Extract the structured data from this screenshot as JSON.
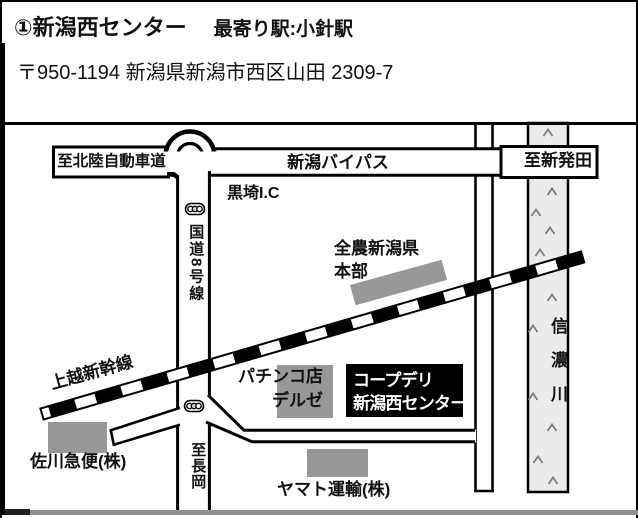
{
  "header": {
    "title": "①新潟西センター",
    "station": "最寄り駅:小針駅",
    "address": "〒950-1194 新潟県新潟市西区山田 2309-7"
  },
  "map": {
    "labels": {
      "to_hokuriku": "至北陸自動車道",
      "bypass": "新潟バイパス",
      "to_shibata": "至新発田",
      "kurosaki_ic": "黒埼I.C",
      "route8": "国道8号線",
      "to_nagaoka": "至長岡",
      "shinkansen": "上越新幹線",
      "river": "信濃川",
      "zennoh_l1": "全農新潟県",
      "zennoh_l2": "本部",
      "pachinko_l1": "パチンコ店",
      "pachinko_l2": "デルゼ",
      "coop_l1": "コープデリ",
      "coop_l2": "新潟西センター",
      "sagawa": "佐川急便(株)",
      "yamato": "ヤマト運輸(株)"
    },
    "colors": {
      "building_gray": "#989898",
      "river_fill": "#ebebeb",
      "destination_box": "#000000"
    }
  }
}
